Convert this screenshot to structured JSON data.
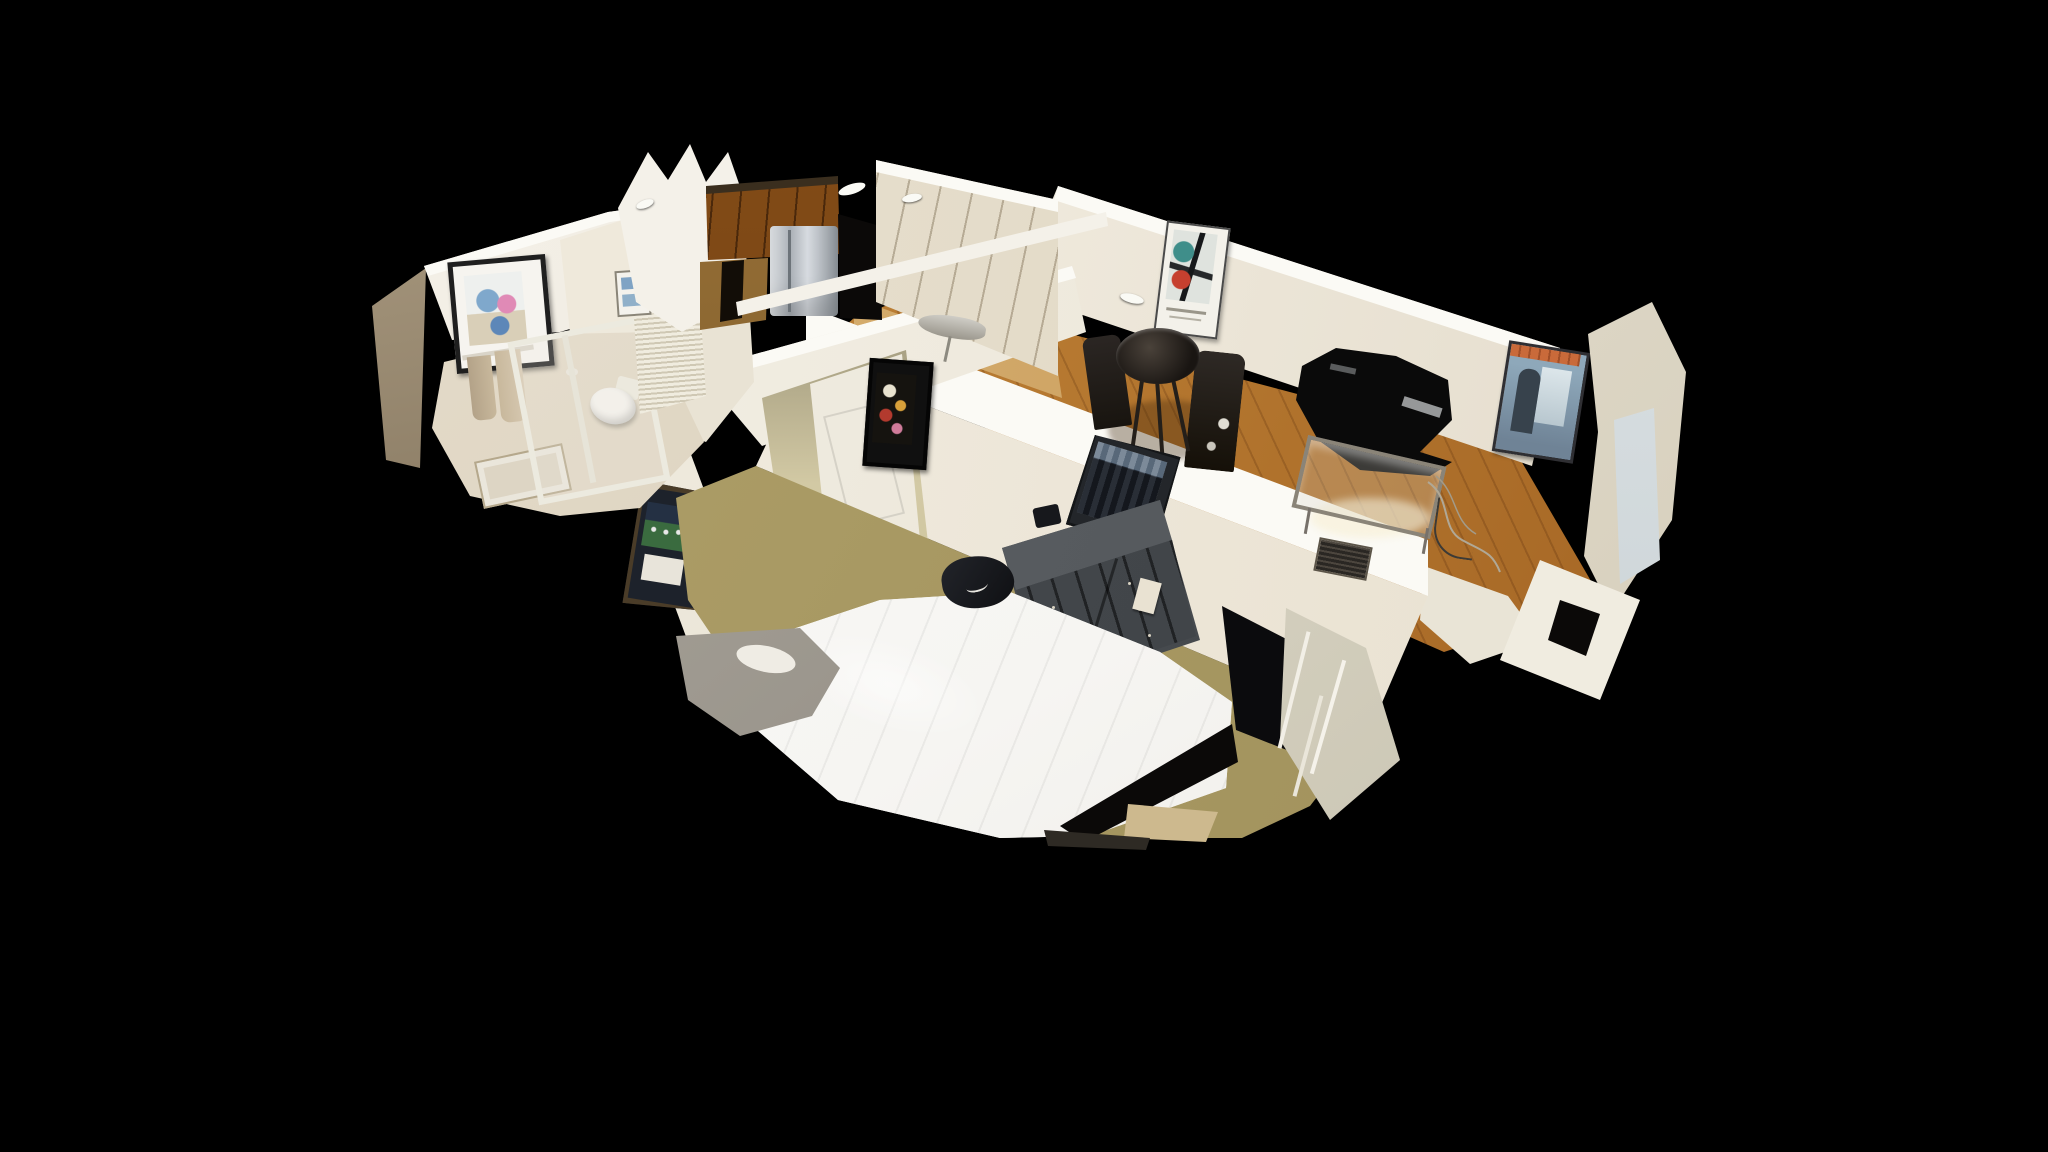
{
  "app": {
    "name": "3d-home-tour-viewer",
    "view_mode": "dollhouse"
  },
  "canvas": {
    "width": 2048,
    "height": 1152,
    "background": "#000000"
  },
  "palette": {
    "bg": "#000000",
    "wall": "#f2eee5",
    "wall-bright": "#fbfaf5",
    "wall-shade": "#ddd4c2",
    "oak-light": "#e6c382",
    "oak-dark": "#b9884a",
    "cabinet-oak": "#b98d4e",
    "cabinet-oak-dark": "#8a6430",
    "carpet": "#d2c9a4",
    "carpet-dark": "#c3b88e",
    "duvet": "#f6f5f2",
    "dresser": "#45494d",
    "dresser-top": "#62666a",
    "furniture-dark": "#241f1a",
    "void-black": "#0b0908",
    "fridge-silver": "#c3c9ce",
    "towel-tan": "#c8b89c",
    "poster-orange": "#c96a3a",
    "poster-blue": "#8ea8ba",
    "art-red": "#c6402f",
    "art-teal": "#3f8e8a",
    "field-green": "#3a6b3f",
    "glass": "#dfe4e6"
  },
  "scene": {
    "description": "Cut-away 3D dollhouse scan of a one-bedroom apartment viewed from above on a black background",
    "rooms": [
      {
        "name": "bathroom",
        "items": [
          "framed watercolor art",
          "towel bar with two tan towels",
          "toilet",
          "glass shower panel",
          "louvered closet doors",
          "bath rug",
          "marble floor"
        ]
      },
      {
        "name": "kitchen",
        "items": [
          "oak wall cabinets",
          "stainless steel refrigerator",
          "white scan fragment"
        ]
      },
      {
        "name": "entry-hall",
        "items": [
          "white paneled closet doors",
          "oak floor",
          "ironing board",
          "door header beam"
        ]
      },
      {
        "name": "living-dining-room",
        "items": [
          "abstract exhibition poster",
          "round dark dining table",
          "two dark chairs with cowhide",
          "wall tv with torn scan hole",
          "metal and glass media console",
          "new york jazz poster",
          "air vent",
          "oak plank floor",
          "window scan fragments",
          "wall wires"
        ]
      },
      {
        "name": "bedroom",
        "items": [
          "queen bed with white duvet",
          "dark eight-drawer dresser",
          "black and white cityscape print",
          "framed flower still life",
          "framed sports memorabilia",
          "open white door to hallway",
          "clothes pile on carpet",
          "leaning tv panel",
          "white radiator fragment",
          "khaki carpet",
          "gray scan fragment"
        ]
      }
    ]
  }
}
